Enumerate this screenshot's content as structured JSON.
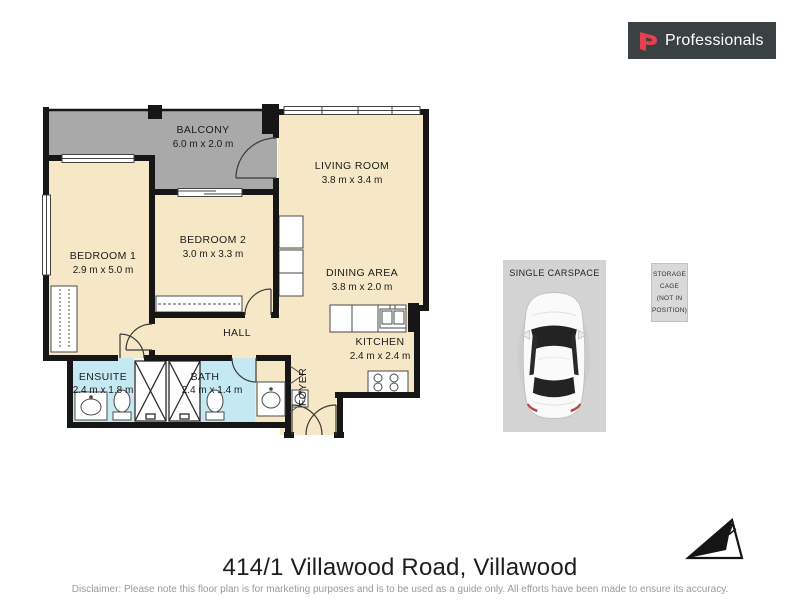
{
  "logo": {
    "brand": "Professionals",
    "bg": "#3b4043",
    "accent": "#e4414f"
  },
  "floorplan": {
    "colors": {
      "room": "#f6e8c6",
      "balcony": "#a9a9a9",
      "wet": "#c5e9f2",
      "wall": "#161616"
    },
    "rooms": {
      "balcony": {
        "name": "BALCONY",
        "dims": "6.0 m x 2.0 m"
      },
      "living": {
        "name": "LIVING ROOM",
        "dims": "3.8 m x 3.4 m"
      },
      "bedroom1": {
        "name": "BEDROOM 1",
        "dims": "2.9 m x 5.0 m"
      },
      "bedroom2": {
        "name": "BEDROOM 2",
        "dims": "3.0 m x 3.3 m"
      },
      "dining": {
        "name": "DINING AREA",
        "dims": "3.8 m x 2.0 m"
      },
      "kitchen": {
        "name": "KITCHEN",
        "dims": "2.4 m x 2.4 m"
      },
      "hall": {
        "name": "HALL"
      },
      "ensuite": {
        "name": "ENSUITE",
        "dims": "2.4 m x 1.8 m"
      },
      "bath": {
        "name": "BATH",
        "dims": "2.4 m x 1.4 m"
      },
      "foyer": {
        "name": "FOYER"
      }
    }
  },
  "parking": {
    "carspace_label": "SINGLE CARSPACE",
    "storage_lines": [
      "STORAGE",
      "CAGE",
      "(NOT IN",
      "POSITION)"
    ]
  },
  "compass": {
    "north": "N"
  },
  "footer": {
    "address": "414/1 Villawood Road, Villawood",
    "disclaimer": "Disclaimer: Please note this floor plan is for marketing purposes and is to be used as a guide only. All efforts have been made to ensure its accuracy."
  }
}
